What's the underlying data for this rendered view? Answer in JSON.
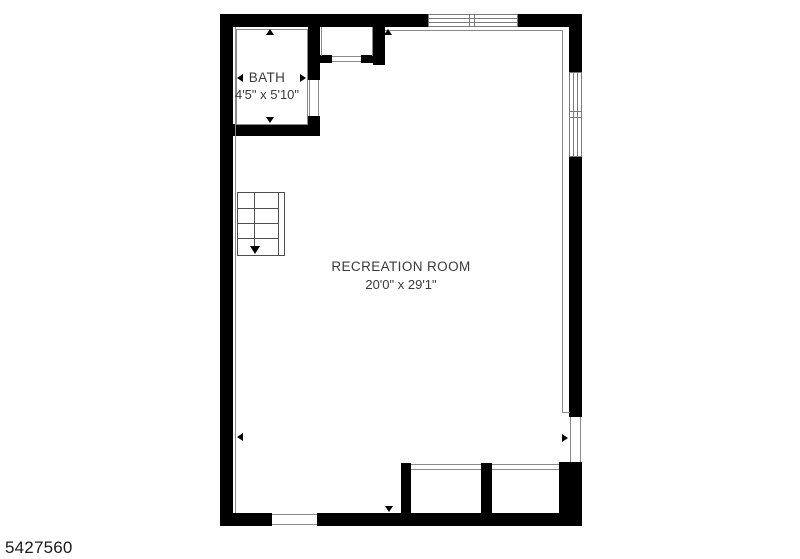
{
  "floorplan": {
    "listing_number": "5427560",
    "rooms": [
      {
        "name": "BATH",
        "dimensions": "4'5\" x 5'10\""
      },
      {
        "name": "RECREATION ROOM",
        "dimensions": "20'0\" x 29'1\""
      }
    ],
    "icons": [
      "dimension-arrow-up",
      "dimension-arrow-down",
      "dimension-arrow-left",
      "dimension-arrow-right",
      "stair-direction-arrow"
    ],
    "colors": {
      "wall": "#000000",
      "thin_line": "#8a8a8a",
      "stair_line": "#4f4f4f",
      "text": "#3a3a3a",
      "background": "#ffffff"
    }
  }
}
